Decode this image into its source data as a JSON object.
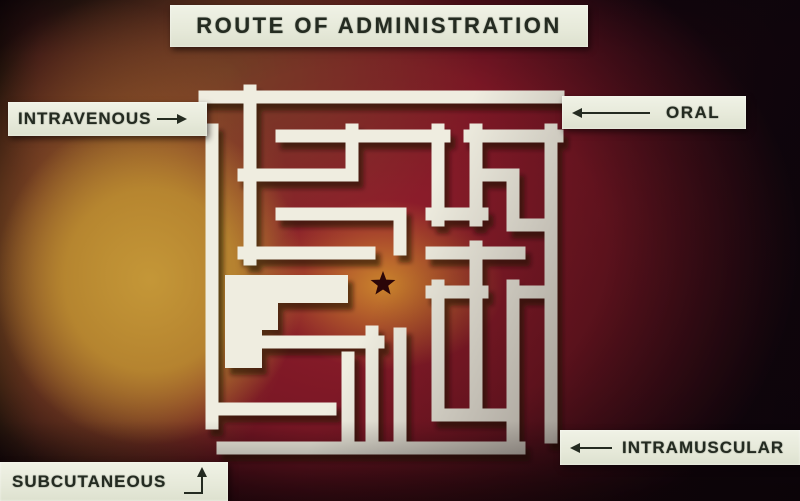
{
  "title": {
    "text": "ROUTE OF ADMINISTRATION"
  },
  "labels": {
    "intravenous": {
      "text": "INTRAVENOUS",
      "arrow": "right-arrow"
    },
    "oral": {
      "text": "ORAL",
      "arrow": "left-long-arrow"
    },
    "intramuscular": {
      "text": "INTRAMUSCULAR",
      "arrow": "left-arrow"
    },
    "subcutaneous": {
      "text": "SUBCUTANEOUS",
      "arrow": "elbow-up-arrow"
    }
  },
  "colors": {
    "wall": "#efede0",
    "wall_shadow": "#200a06",
    "star": "#2b0608",
    "plate_bg": "#e9ecdd",
    "plate_text": "#242b21",
    "bg_crimson": "#8e1c2e",
    "bg_yellow": "#c59838",
    "bg_center_orange": "#ce8a2c",
    "bg_dark_edge": "#120510"
  },
  "maze": {
    "wall_width": 13,
    "walls": [
      [
        [
          205,
          97
        ],
        [
          558,
          97
        ]
      ],
      [
        [
          212,
          130
        ],
        [
          212,
          423
        ]
      ],
      [
        [
          551,
          130
        ],
        [
          551,
          437
        ]
      ],
      [
        [
          223,
          448
        ],
        [
          519,
          448
        ]
      ],
      [
        [
          250,
          91
        ],
        [
          250,
          259
        ]
      ],
      [
        [
          244,
          253
        ],
        [
          369,
          253
        ]
      ],
      [
        [
          244,
          175
        ],
        [
          352,
          175
        ],
        [
          352,
          130
        ]
      ],
      [
        [
          282,
          136
        ],
        [
          444,
          136
        ]
      ],
      [
        [
          282,
          214
        ],
        [
          400,
          214
        ],
        [
          400,
          249
        ]
      ],
      [
        [
          438,
          130
        ],
        [
          438,
          220
        ]
      ],
      [
        [
          432,
          214
        ],
        [
          482,
          214
        ]
      ],
      [
        [
          476,
          130
        ],
        [
          476,
          220
        ]
      ],
      [
        [
          470,
          136
        ],
        [
          557,
          136
        ]
      ],
      [
        [
          476,
          175
        ],
        [
          513,
          175
        ],
        [
          513,
          225
        ],
        [
          551,
          225
        ]
      ],
      [
        [
          432,
          253
        ],
        [
          519,
          253
        ]
      ],
      [
        [
          476,
          247
        ],
        [
          476,
          412
        ]
      ],
      [
        [
          432,
          292
        ],
        [
          482,
          292
        ]
      ],
      [
        [
          438,
          286
        ],
        [
          438,
          415
        ]
      ],
      [
        [
          513,
          292
        ],
        [
          551,
          292
        ]
      ],
      [
        [
          513,
          286
        ],
        [
          513,
          448
        ]
      ],
      [
        [
          438,
          415
        ],
        [
          513,
          415
        ]
      ],
      [
        [
          262,
          342
        ],
        [
          378,
          342
        ]
      ],
      [
        [
          372,
          332
        ],
        [
          372,
          442
        ]
      ],
      [
        [
          348,
          358
        ],
        [
          348,
          442
        ]
      ],
      [
        [
          400,
          334
        ],
        [
          400,
          442
        ]
      ],
      [
        [
          225,
          409
        ],
        [
          330,
          409
        ]
      ]
    ],
    "blob_points": "225,275 348,275 348,303 278,303 278,330 262,330 262,368 225,368",
    "star_path": "M383,271 L386.2,279.6 L395.4,280 L388.2,285.7 L390.6,294.5 L383,289.5 L375.4,294.5 L377.8,285.7 L370.6,280 L379.8,279.6 Z"
  }
}
